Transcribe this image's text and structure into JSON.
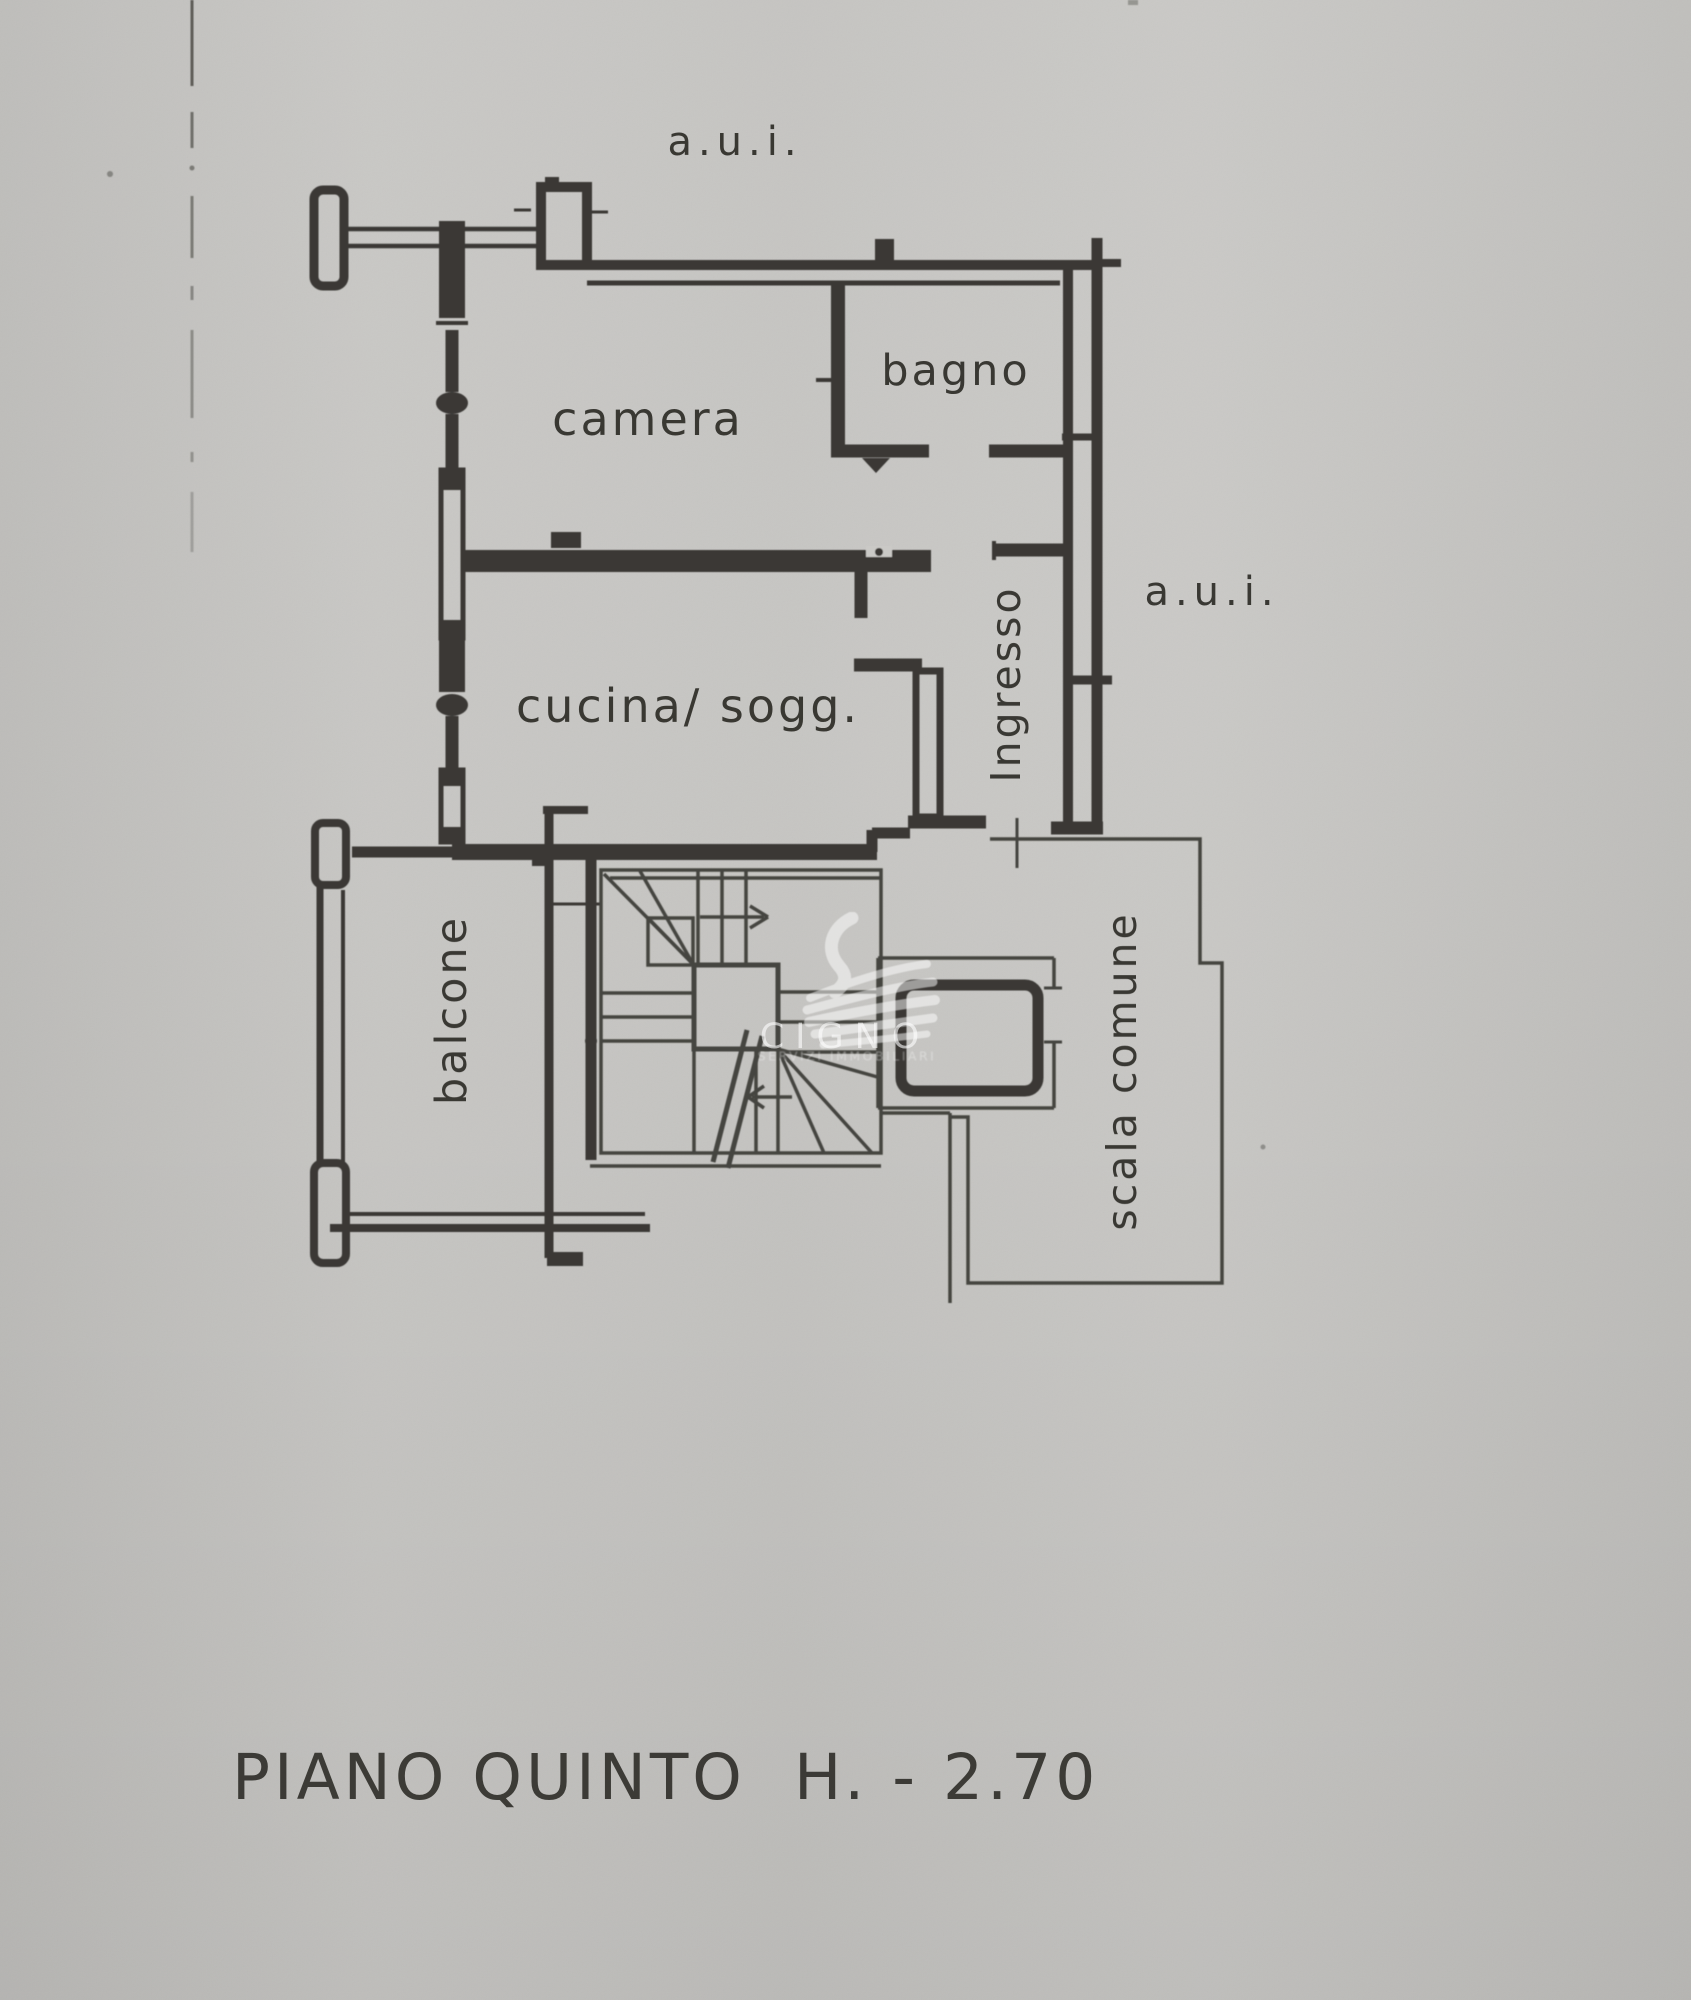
{
  "page": {
    "background_color": "#cac9c6",
    "ink_color": "#3a3935"
  },
  "plan": {
    "labels": {
      "aui_top": "a.u.i.",
      "aui_right": "a.u.i.",
      "camera": "camera",
      "bagno": "bagno",
      "cucina": "cucina/ sogg.",
      "ingresso": "Ingresso",
      "balcone": "balcone",
      "scala_comune": "scala comune"
    }
  },
  "watermark": {
    "brand": "CIGNO",
    "subtext": "SERVIZI IMMOBILIARI"
  },
  "title": "PIANO QUINTO  H. - 2.70"
}
